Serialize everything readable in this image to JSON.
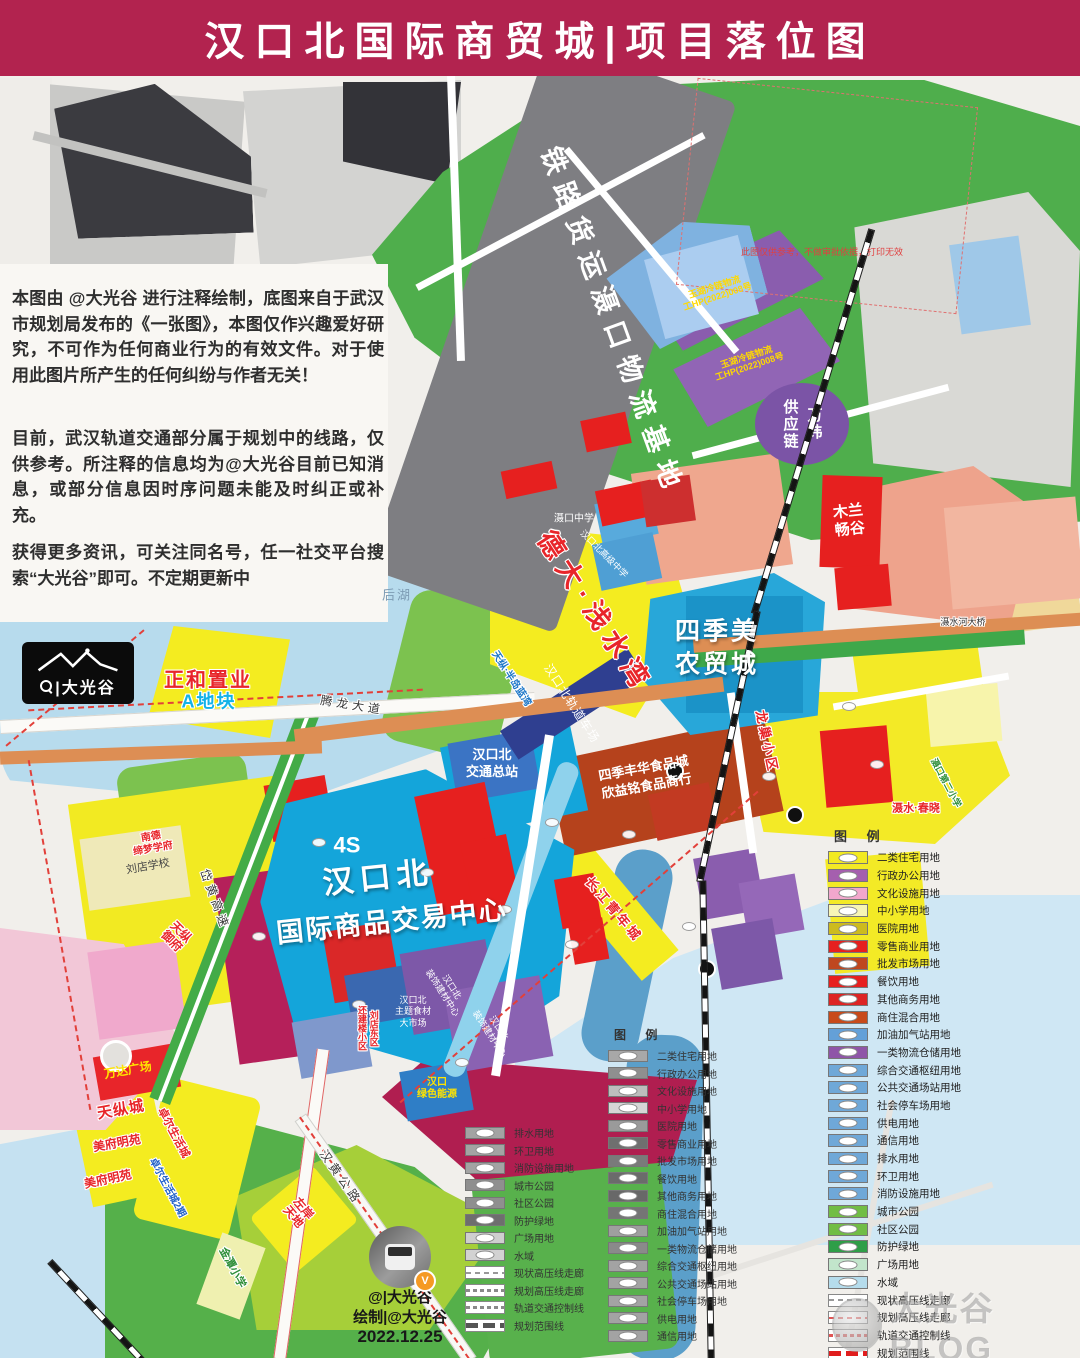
{
  "header": {
    "title": "汉口北国际商贸城|项目落位图"
  },
  "colors": {
    "header_bg": "#b2234f",
    "boundary_red": "#e2403a",
    "water": "#b7dbed",
    "center_cyan": "#14a5da"
  },
  "disclaimer": {
    "p1": "本图由 @大光谷 进行注释绘制，底图来自于武汉市规划局发布的《一张图》，本图仅作兴趣爱好研究，不可作为任何商业行为的有效文件。对于使用此图片所产生的任何纠纷与作者无关！",
    "p2": "目前，武汉轨道交通部分属于规划中的线路，仅供参考。所注释的信息均为@大光谷目前已知消息，或部分信息因时序问题未能及时纠正或补充。",
    "p3": "获得更多资讯，可关注同名号，任一社交平台搜索“大光谷”即可。不定期更新中"
  },
  "logo": {
    "text": "|大光谷"
  },
  "vanke": {
    "name": "万纬供应链",
    "left_col": "供应链",
    "right_col": "万纬"
  },
  "credit": {
    "handle": "@|大光谷",
    "author": "绘制|@大光谷",
    "date": "2022.12.25",
    "badge": "V"
  },
  "watermark": "大光谷BLOG",
  "legend_color": {
    "title": "图 例",
    "items": [
      {
        "label": "二类住宅用地",
        "color": "#f2ea21"
      },
      {
        "label": "行政办公用地",
        "color": "#a55fae"
      },
      {
        "label": "文化设施用地",
        "color": "#f2a7cd"
      },
      {
        "label": "中小学用地",
        "color": "#f7f5b5"
      },
      {
        "label": "医院用地",
        "color": "#cdbb1e"
      },
      {
        "label": "零售商业用地",
        "color": "#e6201f"
      },
      {
        "label": "批发市场用地",
        "color": "#bf471f"
      },
      {
        "label": "餐饮用地",
        "color": "#e6201f"
      },
      {
        "label": "其他商务用地",
        "color": "#dd2424"
      },
      {
        "label": "商住混合用地",
        "color": "#c84a1a"
      },
      {
        "label": "加油加气站用地",
        "color": "#64a0d8"
      },
      {
        "label": "一类物流仓储用地",
        "color": "#8f55a8"
      },
      {
        "label": "综合交通枢纽用地",
        "color": "#6fa8d8"
      },
      {
        "label": "公共交通场站用地",
        "color": "#6fa8d8"
      },
      {
        "label": "社会停车场用地",
        "color": "#6fa8d8"
      },
      {
        "label": "供电用地",
        "color": "#6fa8d8"
      },
      {
        "label": "通信用地",
        "color": "#6fa8d8"
      },
      {
        "label": "排水用地",
        "color": "#6fa8d8"
      },
      {
        "label": "环卫用地",
        "color": "#6fa8d8"
      },
      {
        "label": "消防设施用地",
        "color": "#6fa8d8"
      },
      {
        "label": "城市公园",
        "color": "#71bd45"
      },
      {
        "label": "社区公园",
        "color": "#71bd45"
      },
      {
        "label": "防护绿地",
        "color": "#2f9e48"
      },
      {
        "label": "广场用地",
        "color": "#c2e5cb"
      },
      {
        "label": "水域",
        "color": "#b5dcec"
      }
    ],
    "lines": [
      {
        "label": "现状高压线走廊",
        "style": "dash-gray"
      },
      {
        "label": "规划高压线走廊",
        "style": "dash-red"
      },
      {
        "label": "轨道交通控制线",
        "style": "dash-red2"
      },
      {
        "label": "规划范围线",
        "style": "bold-red"
      }
    ]
  },
  "legend_gray": {
    "title": "图 例",
    "right_items": [
      {
        "label": "二类住宅用地",
        "color": "#a8a8a8"
      },
      {
        "label": "行政办公用地",
        "color": "#8f8f8f"
      },
      {
        "label": "文化设施用地",
        "color": "#bdbdbd"
      },
      {
        "label": "中小学用地",
        "color": "#d6d6d6"
      },
      {
        "label": "医院用地",
        "color": "#9a9a9a"
      },
      {
        "label": "零售商业用地",
        "color": "#6f6f6f"
      },
      {
        "label": "批发市场用地",
        "color": "#7a7a7a"
      },
      {
        "label": "餐饮用地",
        "color": "#6b6b6b"
      },
      {
        "label": "其他商务用地",
        "color": "#686868"
      },
      {
        "label": "商住混合用地",
        "color": "#757575"
      },
      {
        "label": "加油加气站用地",
        "color": "#9f9f9f"
      },
      {
        "label": "一类物流仓储用地",
        "color": "#8a8a8a"
      },
      {
        "label": "综合交通枢纽用地",
        "color": "#a3a3a3"
      },
      {
        "label": "公共交通场站用地",
        "color": "#a3a3a3"
      },
      {
        "label": "社会停车场用地",
        "color": "#a3a3a3"
      },
      {
        "label": "供电用地",
        "color": "#a3a3a3"
      },
      {
        "label": "通信用地",
        "color": "#a3a3a3"
      }
    ],
    "left_items": [
      {
        "label": "排水用地",
        "color": "#a3a3a3"
      },
      {
        "label": "环卫用地",
        "color": "#a3a3a3"
      },
      {
        "label": "消防设施用地",
        "color": "#a3a3a3"
      },
      {
        "label": "城市公园",
        "color": "#8f8f8f"
      },
      {
        "label": "社区公园",
        "color": "#8f8f8f"
      },
      {
        "label": "防护绿地",
        "color": "#6e6e6e"
      },
      {
        "label": "广场用地",
        "color": "#cfcfcf"
      },
      {
        "label": "水域",
        "color": "#d2d2d2"
      }
    ],
    "left_lines": [
      {
        "label": "现状高压线走廊",
        "style": "dash-gray"
      },
      {
        "label": "规划高压线走廊",
        "style": "dash-gray2"
      },
      {
        "label": "轨道交通控制线",
        "style": "dash-gray2"
      },
      {
        "label": "规划范围线",
        "style": "bold-gray"
      }
    ]
  },
  "map_labels": [
    {
      "n": "label-railway-logistics-base",
      "t": "铁路货运滠口物流基地",
      "x": 612,
      "y": 322,
      "fs": 27,
      "c": "#ffffff",
      "rot": 70,
      "b": 1,
      "ls": 10
    },
    {
      "n": "label-yuhu-cold-chain-1",
      "t": "玉湖冷链物流\n工HP(2022)008号",
      "x": 716,
      "y": 292,
      "fs": 9,
      "c": "#ffd900",
      "rot": -18,
      "b": 1
    },
    {
      "n": "label-yuhu-cold-chain-2",
      "t": "玉湖冷链物流\n工HP(2022)008号",
      "x": 748,
      "y": 362,
      "fs": 9,
      "c": "#ffd900",
      "rot": -18,
      "b": 1
    },
    {
      "n": "label-map-note",
      "t": "此图仅供参考，不做审批依据，打印无效",
      "x": 822,
      "y": 252,
      "fs": 9,
      "c": "#e04040",
      "w": 250
    },
    {
      "n": "label-mulan-changgu",
      "t": "木兰\n畅谷",
      "x": 849,
      "y": 521,
      "fs": 15,
      "c": "#ffffff",
      "b": 1,
      "rot": -6,
      "lh": 1.2
    },
    {
      "n": "label-deda-qianshuiwan",
      "t": "德大·浅水湾",
      "x": 594,
      "y": 612,
      "fs": 27,
      "c": "#e8252a",
      "rot": 57,
      "b": 1,
      "ls": 7,
      "st": "w"
    },
    {
      "n": "label-sijimei-market",
      "t": "四季美\n农贸城",
      "x": 717,
      "y": 648,
      "fs": 25,
      "c": "#ffffff",
      "b": 1,
      "ls": 3,
      "lh": 1.3,
      "st": "d"
    },
    {
      "n": "label-hankoubei-rail-yard",
      "t": "汉口北轨道车场",
      "x": 571,
      "y": 704,
      "fs": 12,
      "c": "#ffffff",
      "rot": 57,
      "ls": 1
    },
    {
      "n": "label-shekou-middle-school",
      "t": "滠口中学",
      "x": 574,
      "y": 519,
      "fs": 10,
      "c": "#ffffff"
    },
    {
      "n": "label-hankoubei-high-school",
      "t": "汉口北高级中学",
      "x": 604,
      "y": 554,
      "fs": 9,
      "c": "#ffffff",
      "rot": 45
    },
    {
      "n": "label-zhenghe-zhiye",
      "t": "正和置业",
      "x": 208,
      "y": 681,
      "fs": 20,
      "c": "#e8252a",
      "b": 1,
      "st": "w",
      "ls": 2
    },
    {
      "n": "label-a-dikuai",
      "t": "A地块",
      "x": 209,
      "y": 702,
      "fs": 18,
      "c": "#12b2e8",
      "b": 1,
      "st": "w",
      "ls": 2
    },
    {
      "n": "label-houhu",
      "t": "后湖",
      "x": 397,
      "y": 596,
      "fs": 13,
      "c": "#7d9cb4",
      "ls": 2
    },
    {
      "n": "label-tenglong-avenue",
      "t": "腾龙大道",
      "x": 352,
      "y": 706,
      "fs": 12,
      "c": "#3a3a3a",
      "rot": 9,
      "ls": 4,
      "st": "w"
    },
    {
      "n": "label-daihuang-expressway",
      "t": "岱黄高速",
      "x": 214,
      "y": 900,
      "fs": 12,
      "c": "#3a3a3a",
      "rot": 70,
      "ls": 4,
      "st": "w"
    },
    {
      "n": "label-hanhuang-highway",
      "t": "汉黄公路",
      "x": 340,
      "y": 1178,
      "fs": 12,
      "c": "#3a3a3a",
      "rot": 55,
      "ls": 4,
      "st": "w"
    },
    {
      "n": "label-sheshui-bridge",
      "t": "滠水河大桥",
      "x": 963,
      "y": 622,
      "fs": 9,
      "c": "#333333",
      "st": "w"
    },
    {
      "n": "label-transit-terminal",
      "t": "汉口北\n交通总站",
      "x": 492,
      "y": 764,
      "fs": 13,
      "c": "#ffffff",
      "b": 1,
      "lh": 1.3
    },
    {
      "n": "label-sijifenghua",
      "t": "四季丰华食品城\n欣益铭食品商行",
      "x": 645,
      "y": 777,
      "fs": 13,
      "c": "#ffffff",
      "b": 1,
      "rot": -10,
      "lh": 1.35
    },
    {
      "n": "label-hankoubei-line1",
      "t": "汉口北",
      "x": 378,
      "y": 878,
      "fs": 31,
      "c": "#ffffff",
      "b": 1,
      "rot": -6,
      "ls": 6,
      "st": "d"
    },
    {
      "n": "label-hankoubei-line2",
      "t": "国际商品交易中心",
      "x": 392,
      "y": 922,
      "fs": 27,
      "c": "#ffffff",
      "b": 1,
      "rot": -6,
      "ls": 2,
      "st": "d"
    },
    {
      "n": "label-4s",
      "t": "4S",
      "x": 347,
      "y": 845,
      "fs": 22,
      "c": "#ffffff",
      "b": 1
    },
    {
      "n": "label-wanda-plaza",
      "t": "万达广场",
      "x": 128,
      "y": 1071,
      "fs": 12,
      "c": "#ffe400",
      "b": 1,
      "rot": -10
    },
    {
      "n": "label-tianzongcheng",
      "t": "天纵城",
      "x": 121,
      "y": 1110,
      "fs": 15,
      "c": "#e8252a",
      "b": 1,
      "rot": -10,
      "st": "w",
      "ls": 1
    },
    {
      "n": "label-meifumingyuan-1",
      "t": "美府明苑",
      "x": 117,
      "y": 1144,
      "fs": 12,
      "c": "#e8252a",
      "b": 1,
      "rot": -10,
      "st": "w"
    },
    {
      "n": "label-meifumingyuan-2",
      "t": "美府明苑",
      "x": 108,
      "y": 1180,
      "fs": 12,
      "c": "#e8252a",
      "b": 1,
      "rot": -12,
      "st": "w"
    },
    {
      "n": "label-zhuoer-life-city",
      "t": "卓尔生活城",
      "x": 173,
      "y": 1133,
      "fs": 11,
      "c": "#e8252a",
      "b": 1,
      "rot": 62,
      "st": "w"
    },
    {
      "n": "label-zhuoer-life-city-2",
      "t": "卓尔生活城2期",
      "x": 167,
      "y": 1188,
      "fs": 10,
      "c": "#2060c8",
      "b": 1,
      "rot": 62,
      "st": "w"
    },
    {
      "n": "label-zuoan-tiandi",
      "t": "左岸\n天地",
      "x": 298,
      "y": 1213,
      "fs": 12,
      "c": "#e8252a",
      "b": 1,
      "rot": 50,
      "st": "w",
      "lh": 1.1
    },
    {
      "n": "label-jintan-primary",
      "t": "金潭小学",
      "x": 232,
      "y": 1268,
      "fs": 11,
      "c": "#2f8f3a",
      "b": 1,
      "rot": 62,
      "st": "w"
    },
    {
      "n": "label-liudian-school",
      "t": "刘店学校",
      "x": 148,
      "y": 867,
      "fs": 11,
      "c": "#444444",
      "rot": -10
    },
    {
      "n": "label-nande-school",
      "t": "南德\n缔梦学府",
      "x": 152,
      "y": 843,
      "fs": 10,
      "c": "#e8252a",
      "b": 1,
      "rot": -10,
      "st": "w",
      "lh": 1.15
    },
    {
      "n": "label-tianzong-yufu",
      "t": "天纵\n御府",
      "x": 176,
      "y": 937,
      "fs": 12,
      "c": "#e8252a",
      "b": 1,
      "rot": 45,
      "st": "w",
      "lh": 1.1
    },
    {
      "n": "label-longchao-community",
      "t": "龙巢小区",
      "x": 766,
      "y": 742,
      "fs": 13,
      "c": "#e8252a",
      "b": 1,
      "rot": 78,
      "st": "w",
      "ls": 3
    },
    {
      "n": "label-sheshui-chunxiao",
      "t": "滠水·春晓",
      "x": 916,
      "y": 809,
      "fs": 11,
      "c": "#e8252a",
      "b": 1,
      "st": "w"
    },
    {
      "n": "label-shekou-second-primary",
      "t": "滠口第二小学",
      "x": 946,
      "y": 783,
      "fs": 9,
      "c": "#2f8f3a",
      "b": 1,
      "rot": 62,
      "st": "w"
    },
    {
      "n": "label-changjiang-youth-city",
      "t": "长江青年城",
      "x": 613,
      "y": 910,
      "fs": 13,
      "c": "#e8252a",
      "b": 1,
      "rot": 50,
      "ls": 3,
      "st": "w"
    },
    {
      "n": "label-tianzong-peninsula",
      "t": "天纵·半岛蓝湾",
      "x": 511,
      "y": 679,
      "fs": 10,
      "c": "#1f78c8",
      "b": 1,
      "rot": 57,
      "st": "w"
    },
    {
      "n": "label-theme-food-market",
      "t": "汉口北\n主题食材\n大市场",
      "x": 413,
      "y": 1012,
      "fs": 9,
      "c": "#ffffff",
      "lh": 1.25
    },
    {
      "n": "label-building-material-center-1",
      "t": "汉口北\n装饰建材中心",
      "x": 447,
      "y": 990,
      "fs": 9,
      "c": "#ffffff",
      "rot": 57,
      "lh": 1.2
    },
    {
      "n": "label-building-material-center-2",
      "t": "汉口北\n装饰建材中心",
      "x": 494,
      "y": 1031,
      "fs": 9,
      "c": "#ffffff",
      "rot": 57,
      "lh": 1.2
    },
    {
      "n": "label-liudian-dongqu",
      "t": "刘店东区\n还建楼小区",
      "x": 367,
      "y": 1028,
      "fs": 9,
      "c": "#e8252a",
      "b": 1,
      "v": 1,
      "st": "w",
      "lh": 1.3
    },
    {
      "n": "label-hankou-green-energy",
      "t": "汉口\n绿色能源",
      "x": 437,
      "y": 1089,
      "fs": 10,
      "c": "#ffe400",
      "b": 1,
      "lh": 1.2
    }
  ]
}
